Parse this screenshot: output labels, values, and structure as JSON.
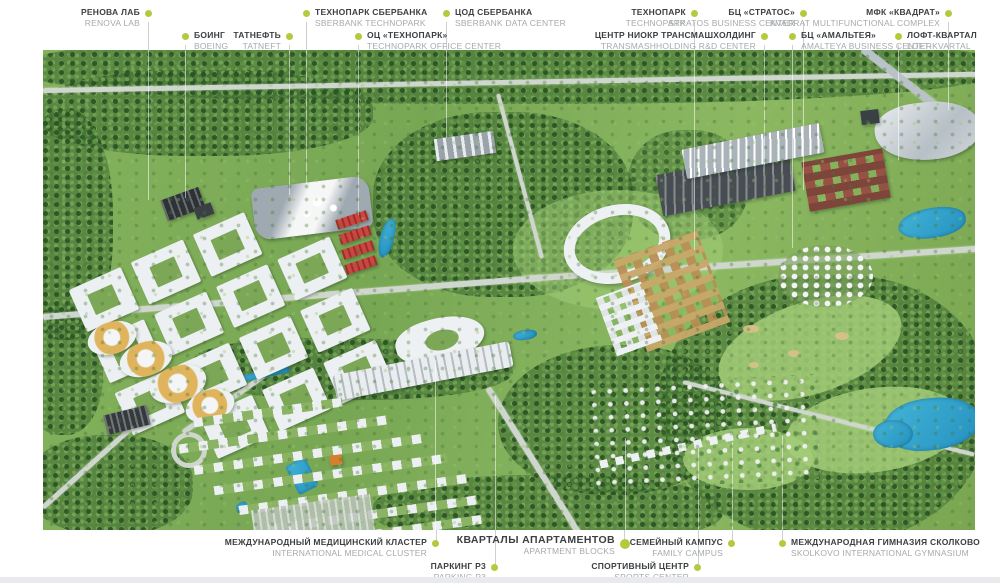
{
  "title": "Skolkovo masterplan aerial render with building callouts",
  "colors": {
    "marker": "#b5c93c",
    "label_ru": "#3d4043",
    "label_en": "#a6aaad",
    "highlight_red": "#c94641",
    "water": "#2f9fd4",
    "leader_line": "#cbd0d3"
  },
  "top_labels": [
    {
      "ru": "РЕНОВА ЛАБ",
      "en": "RENOVA LAB"
    },
    {
      "ru": "БОИНГ",
      "en": "BOEING"
    },
    {
      "ru": "ТАТНЕФТЬ",
      "en": "TATNEFT"
    },
    {
      "ru": "ТЕХНОПАРК СБЕРБАНКА",
      "en": "SBERBANK TECHNOPARK"
    },
    {
      "ru": "ОЦ «ТЕХНОПАРК»",
      "en": "TECHNOPARK OFFICE CENTER"
    },
    {
      "ru": "ЦОД СБЕРБАНКА",
      "en": "SBERBANK DATA CENTER"
    },
    {
      "ru": "ТЕХНОПАРК",
      "en": "TECHNOPARK"
    },
    {
      "ru": "ЦЕНТР НИОКР ТРАНСМАШХОЛДИНГ",
      "en": "TRANSMASHHOLDING R&D CENTER"
    },
    {
      "ru": "БЦ «СТРАТОС»",
      "en": "STRATOS BUSINESS CENTER"
    },
    {
      "ru": "БЦ «АМАЛЬТЕЯ»",
      "en": "AMALTEYA BUSINESS CENTER"
    },
    {
      "ru": "МФК «КВАДРАТ»",
      "en": "KVADRAT MULTIFUNCTIONAL COMPLEX"
    },
    {
      "ru": "ЛОФТ-КВАРТАЛ",
      "en": "LOFT-KVARTAL"
    }
  ],
  "bottom_labels": [
    {
      "ru": "МЕЖДУНАРОДНЫЙ МЕДИЦИНСКИЙ КЛАСТЕР",
      "en": "INTERNATIONAL MEDICAL CLUSTER"
    },
    {
      "ru": "ПАРКИНГ Р3",
      "en": "PARKING P3"
    },
    {
      "ru": "КВАРТАЛЫ АПАРТАМЕНТОВ",
      "en": "APARTMENT BLOCKS",
      "emphasis": true
    },
    {
      "ru": "СПОРТИВНЫЙ ЦЕНТР",
      "en": "SPORTS CENTER"
    },
    {
      "ru": "СЕМЕЙНЫЙ КАМПУС",
      "en": "FAMILY CAMPUS"
    },
    {
      "ru": "МЕЖДУНАРОДНАЯ ГИМНАЗИЯ СКОЛКОВО",
      "en": "SKOLKOVO INTERNATIONAL GYMNASIUM"
    }
  ]
}
